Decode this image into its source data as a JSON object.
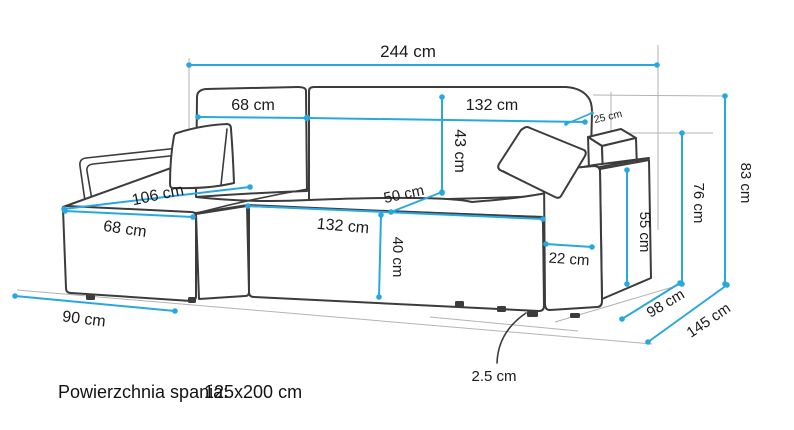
{
  "diagram": {
    "title": "Corner sofa dimension diagram",
    "units": "cm",
    "colors": {
      "dimension_line": "#29a7df",
      "outline": "#3c3c3c",
      "guide_line": "#b3b3b3",
      "label_text": "#1b1b1b",
      "background": "#ffffff"
    },
    "dims": {
      "total_width": "244 cm",
      "back_left_width": "68 cm",
      "back_right_width": "132 cm",
      "back_cushion_height": "43 cm",
      "back_top_depth": "25 cm",
      "chaise_seat_length": "106 cm",
      "seat_depth": "50 cm",
      "chaise_front_width": "68 cm",
      "seat_front_width": "132 cm",
      "seat_height": "40 cm",
      "chaise_side_depth": "90 cm",
      "armrest_width": "22 cm",
      "armrest_height": "55 cm",
      "mid_height": "76 cm",
      "total_height": "83 cm",
      "body_depth": "98 cm",
      "total_depth": "145 cm",
      "leg_height": "2.5 cm"
    },
    "caption": {
      "label": "Powierzchnia spania:",
      "value": "125x200 cm"
    }
  }
}
